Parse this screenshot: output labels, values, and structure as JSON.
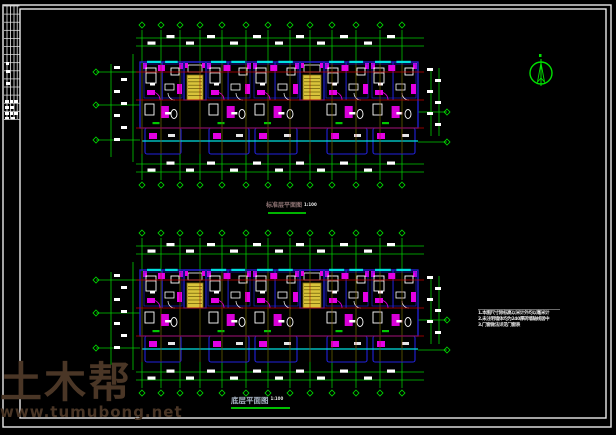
{
  "window": {
    "type": "cad-floor-plan-viewer",
    "background": "#000000"
  },
  "colors": {
    "frame": "#ebebeb",
    "axis_green": "#00cc00",
    "bright_green": "#00e000",
    "red": "#c40000",
    "dark_red": "#9a0000",
    "cyan": "#00e0e0",
    "magenta": "#e400e4",
    "wall_blue": "#2222dd",
    "stair_yellow": "#d9c33b",
    "stair_edge": "#7e6d15",
    "white": "#ffffff",
    "watermark_brown": "#4a3626",
    "underline_green": "#00b400"
  },
  "labels": {
    "top": {
      "text": "标准层平面图",
      "scale": "1:100"
    },
    "bottom": {
      "text": "底层平面图",
      "scale": "1:100"
    }
  },
  "notes": {
    "lines": [
      "1.本图尺寸除标高以米计外均以毫米计",
      "2.未注明墙体均为240厚砖墙轴线居中",
      "3.门窗做法详见门窗表"
    ]
  },
  "watermark": {
    "title": "土木帮",
    "url": "www.tumubong.net"
  },
  "north_arrow": {
    "cx": 541,
    "cy": 73,
    "r": 11
  },
  "cad": {
    "axes_x": [
      142,
      161,
      180,
      200,
      222,
      246,
      268,
      290,
      310,
      332,
      356,
      380,
      402
    ],
    "body_x": [
      140,
      418
    ],
    "plans": [
      {
        "id": "top-plan",
        "y0": 62
      },
      {
        "id": "bottom-plan",
        "y0": 270
      }
    ],
    "bays": [
      {
        "x": 142,
        "w": 42,
        "t": "u"
      },
      {
        "x": 184,
        "w": 22,
        "t": "s"
      },
      {
        "x": 206,
        "w": 46,
        "t": "u"
      },
      {
        "x": 252,
        "w": 48,
        "t": "u"
      },
      {
        "x": 300,
        "w": 24,
        "t": "s"
      },
      {
        "x": 324,
        "w": 46,
        "t": "u"
      },
      {
        "x": 370,
        "w": 48,
        "t": "u"
      }
    ]
  }
}
